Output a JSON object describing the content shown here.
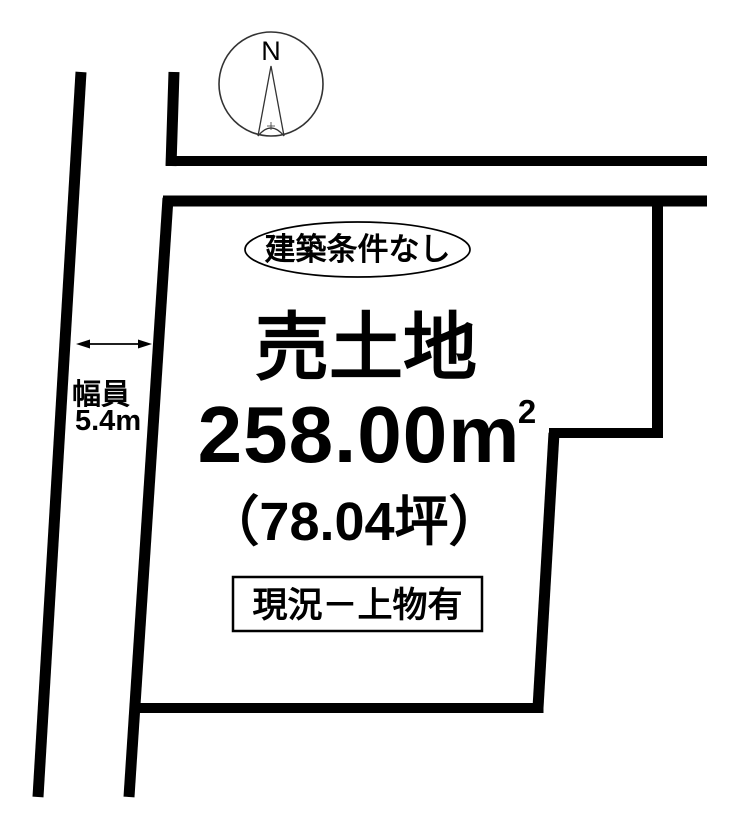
{
  "page": {
    "background": "#ffffff",
    "line_color": "#000000"
  },
  "compass": {
    "label": "N"
  },
  "plot": {
    "badge": "建築条件なし",
    "title": "売土地",
    "area_m2_value": "258.00m",
    "area_m2_superscript": "2",
    "area_tsubo": "（78.04坪）",
    "status": "現況－上物有"
  },
  "road": {
    "width_label": "幅員",
    "width_value": "5.4m"
  }
}
